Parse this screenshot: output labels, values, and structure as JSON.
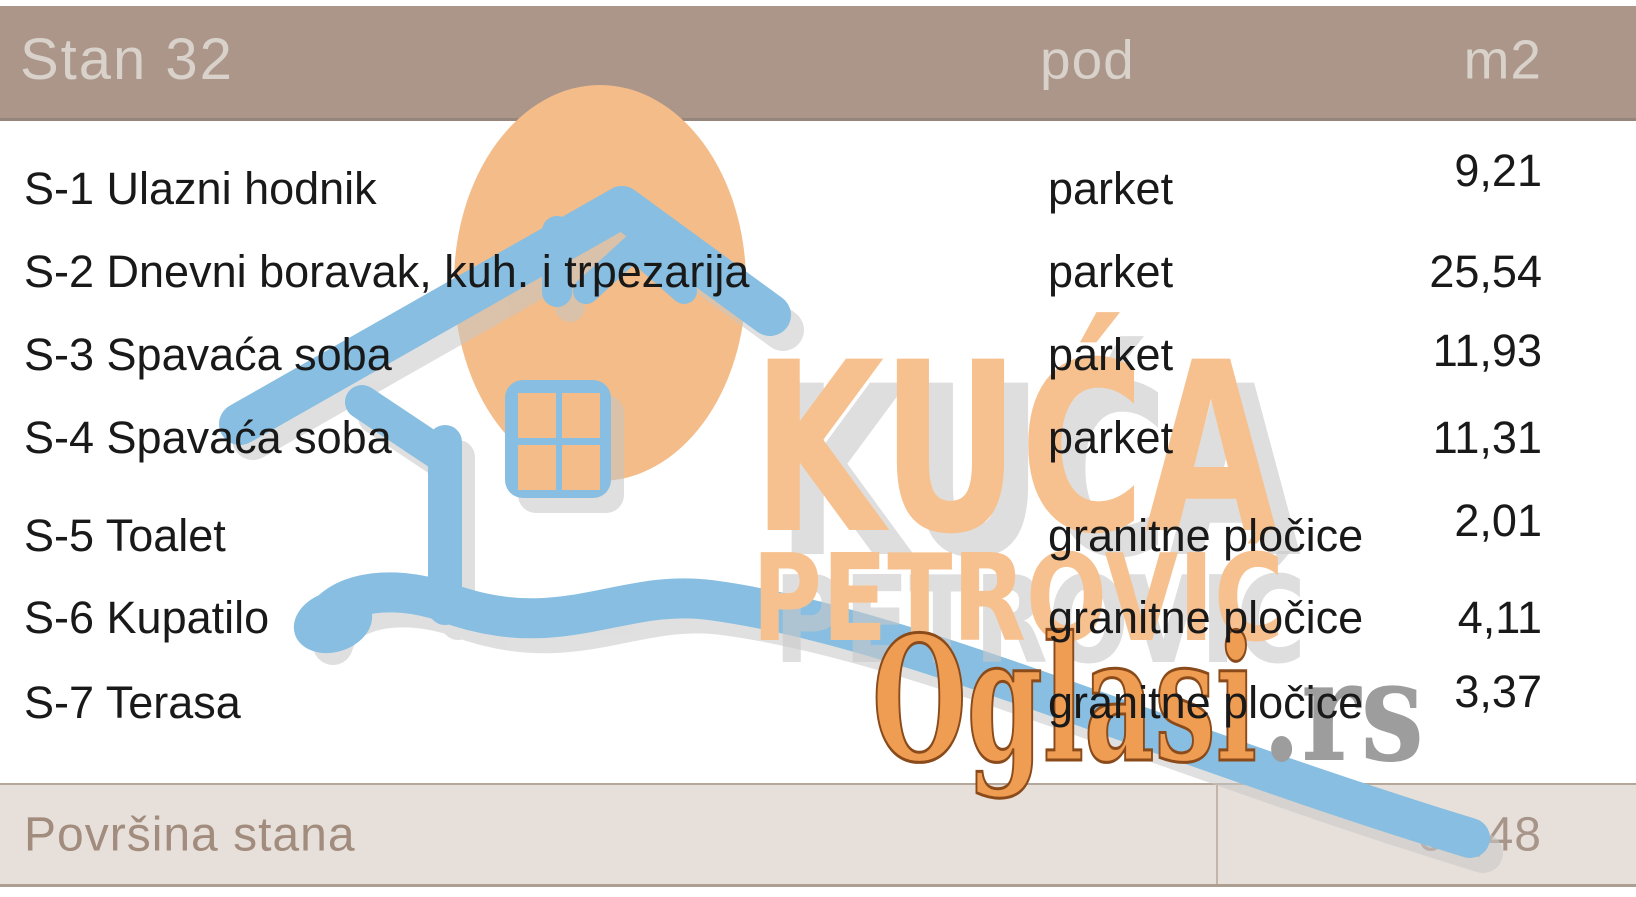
{
  "header": {
    "title": "Stan 32",
    "col_floor": "pod",
    "col_area": "m2"
  },
  "table": {
    "rows": [
      {
        "name": "S-1 Ulazni hodnik",
        "floor": "parket",
        "area": "9,21"
      },
      {
        "name": "S-2 Dnevni boravak, kuh. i trpezarija",
        "floor": "parket",
        "area": "25,54"
      },
      {
        "name": "S-3 Spavaća soba",
        "floor": "parket",
        "area": "11,93"
      },
      {
        "name": "S-4 Spavaća soba",
        "floor": "parket",
        "area": "11,31"
      },
      {
        "name": "S-5 Toalet",
        "floor": "granitne pločice",
        "area": "2,01"
      },
      {
        "name": "S-6 Kupatilo",
        "floor": "granitne pločice",
        "area": "4,11"
      },
      {
        "name": "S-7 Terasa",
        "floor": "granitne pločice",
        "area": "3,37"
      }
    ]
  },
  "footer": {
    "label": "Površina stana",
    "total": "67,48"
  },
  "watermark": {
    "brand_line1": "KUĆA",
    "brand_line2": "PETROVIĆ",
    "site": "Oglasi",
    "site_tld": ".rs"
  },
  "colors": {
    "header_bg": "#ac9689",
    "footer_bg": "#e7e0da",
    "accent_orange": "#f3bc88",
    "accent_blue": "#87bee1",
    "brand_orange": "#f6c18e",
    "site_orange": "#ee9d52",
    "header_text": "#d8d2cb",
    "footer_text": "#a18c7d"
  }
}
